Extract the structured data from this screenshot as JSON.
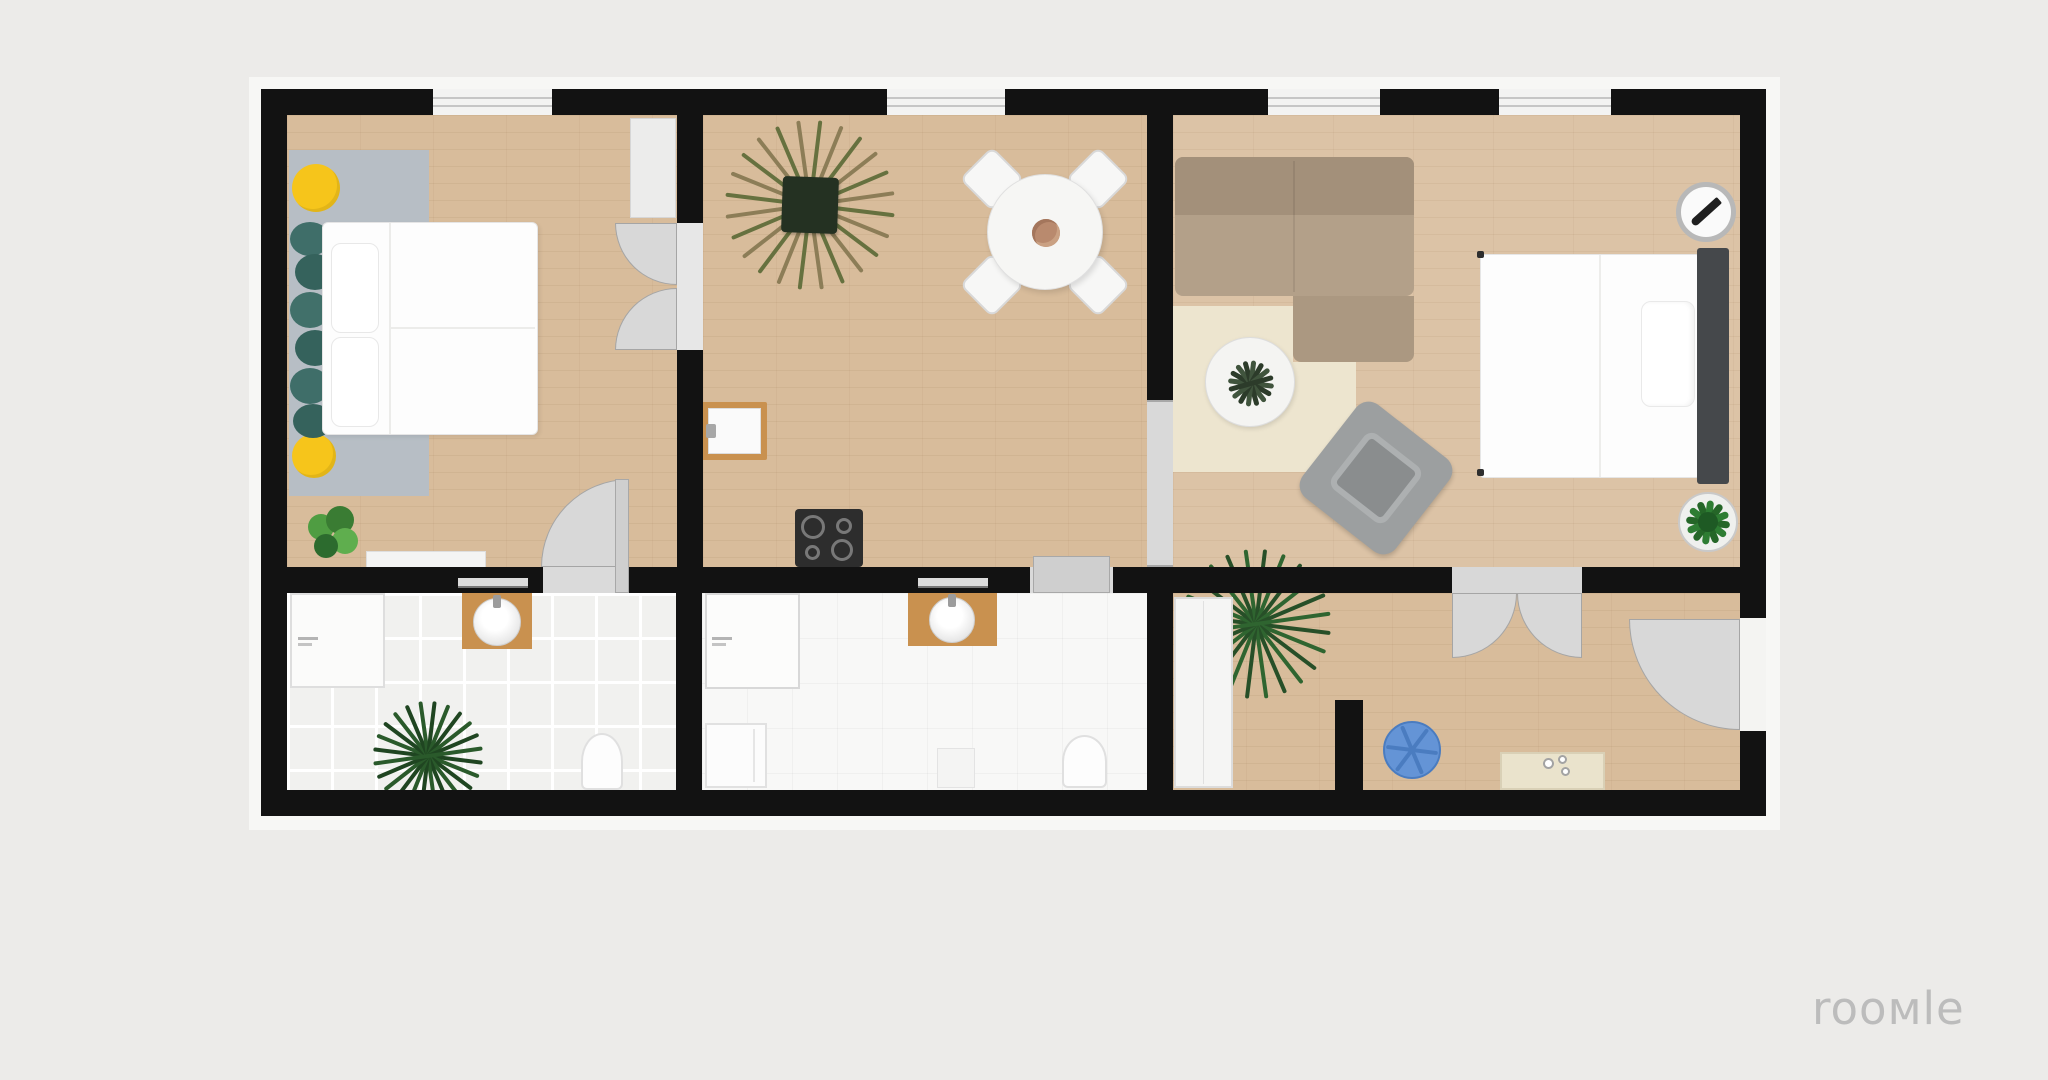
{
  "branding": {
    "logo_text": "rooмle",
    "logo_color": "#bcbcbc"
  },
  "palette": {
    "canvas_bg": "#ecebe9",
    "plan_halo": "#f7f7f5",
    "wall": "#121212",
    "wood_floor": "#d8bc9b",
    "wood_floor_light": "#dcc3a6",
    "tile_floor": "#f1f1ef",
    "door_gray": "#d8d8d8",
    "bedroom_rug": "#b7bec5",
    "pouf_yellow": "#f6c51b",
    "cushion_teal": "#3f6e69",
    "sofa_tan": "#b3a089",
    "living_rug_cream": "#ede5cf",
    "armchair_gray": "#9c9fa0",
    "headboard_dark": "#45484b",
    "pouf_blue": "#6494d6",
    "counter_cream": "#eae3cc",
    "vanity_wood": "#c9914f",
    "stove_dark": "#2d2d2d",
    "plant_green": "#3c8a3c"
  },
  "floorplan": {
    "windows_count": 4,
    "rooms": [
      {
        "name": "bedroom",
        "floor": "wood",
        "furniture": [
          "double-bed",
          "area-rug",
          "yellow-pouf",
          "yellow-pouf",
          "teal-cushions",
          "potted-plant",
          "desk",
          "wardrobe-cabinet"
        ]
      },
      {
        "name": "kitchen-dining",
        "floor": "wood",
        "furniture": [
          "spiky-potted-plant",
          "round-dining-table",
          "table-centerpiece",
          "dining-chair",
          "dining-chair",
          "dining-chair",
          "dining-chair",
          "wall-sink",
          "cooktop"
        ]
      },
      {
        "name": "living-room",
        "floor": "wood",
        "furniture": [
          "corner-sofa",
          "cream-area-rug",
          "round-side-table",
          "table-plant",
          "armchair",
          "double-bed",
          "headboard",
          "compass-dial",
          "potted-plant",
          "palm-plant"
        ]
      },
      {
        "name": "bathroom-left",
        "floor": "tile",
        "furniture": [
          "shower-tray",
          "sink-vanity",
          "mirror",
          "toilet",
          "palm-plant"
        ]
      },
      {
        "name": "bathroom-middle",
        "floor": "tile",
        "furniture": [
          "shower-tray",
          "sink-vanity",
          "mirror",
          "washing-machine",
          "bath-mat",
          "toilet"
        ]
      },
      {
        "name": "hallway-right",
        "floor": "wood",
        "furniture": [
          "tall-wardrobe",
          "blue-pouf",
          "kitchen-counter",
          "partition-wall-stub"
        ]
      }
    ],
    "doors": [
      "bedroom-bathroom-single-door",
      "bedroom-kitchen-double-door",
      "kitchen-bathroom-sliding-door",
      "kitchen-living-pocket-opening",
      "living-hallway-double-door",
      "entrance-door-right-wall"
    ]
  }
}
